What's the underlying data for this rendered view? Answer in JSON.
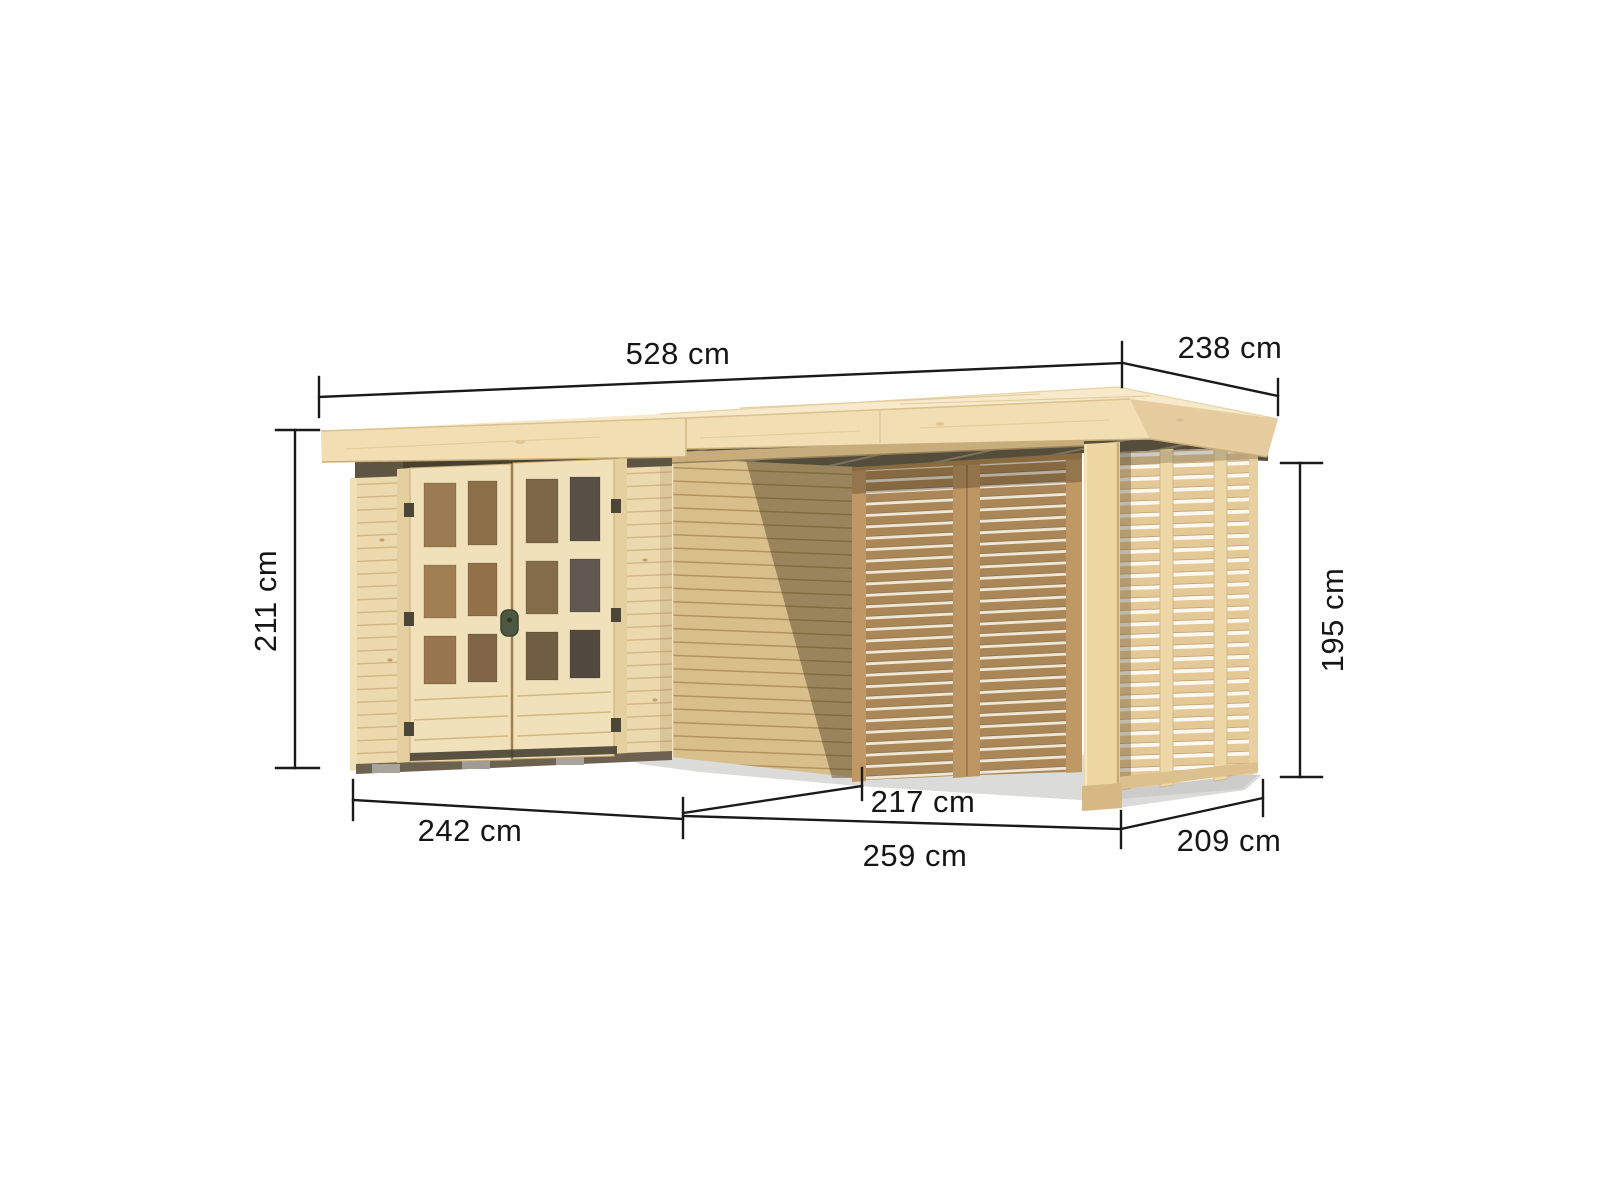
{
  "figure": {
    "type": "product-dimension-diagram",
    "subject": "wooden garden shed with lattice side annex under a shared flat roof",
    "unit": "cm",
    "dimensions": {
      "overall_width": "528 cm",
      "overall_depth": "238 cm",
      "wall_height_left": "211 cm",
      "wall_height_right": "195 cm",
      "shed_front_width": "242 cm",
      "annex_clear_width": "217 cm",
      "annex_front_width": "259 cm",
      "annex_side_depth": "209 cm"
    },
    "colors": {
      "background": "#ffffff",
      "dimension_line": "#1a1a1a",
      "roof_wood": "#f3e2bb",
      "wall_wood": "#ecd9ad",
      "slat_wood_dark": "#ab8757",
      "slat_wood_light": "#e4c895",
      "shadow_band": "#554d3c"
    }
  }
}
